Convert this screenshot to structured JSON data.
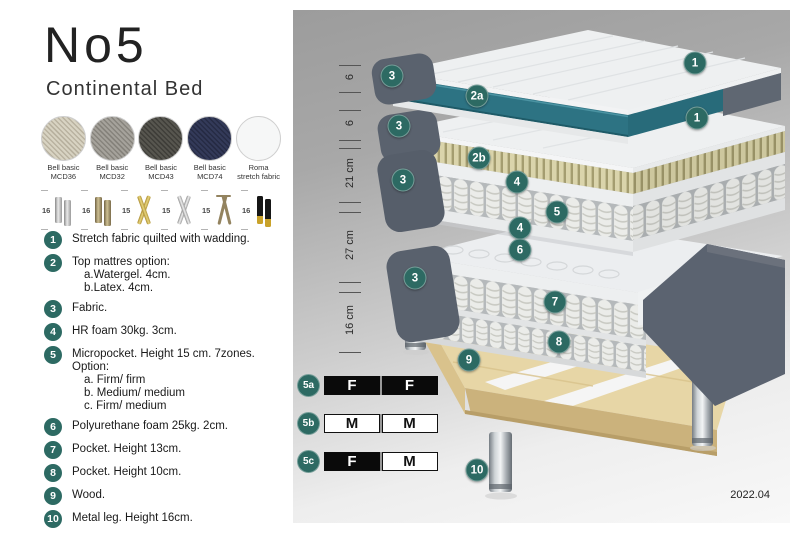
{
  "header": {
    "title": "No5",
    "subtitle": "Continental Bed"
  },
  "fabrics": [
    {
      "line1": "Bell basic",
      "line2": "MCD36",
      "color": "#d8d3c2",
      "weave": "#b9b2a0"
    },
    {
      "line1": "Bell basic",
      "line2": "MCD32",
      "color": "#a5a29b",
      "weave": "#86837c"
    },
    {
      "line1": "Bell basic",
      "line2": "MCD43",
      "color": "#57564f",
      "weave": "#3f3e39"
    },
    {
      "line1": "Bell basic",
      "line2": "MCD74",
      "color": "#333a59",
      "weave": "#262b44"
    },
    {
      "line1": "Roma",
      "line2": "stretch fabric",
      "color": "#f6f7f7",
      "weave": "#eceded"
    }
  ],
  "legs": [
    {
      "height": "16",
      "type": "cylinder-silver"
    },
    {
      "height": "16",
      "type": "cylinder-bronze"
    },
    {
      "height": "15",
      "type": "cross-gold"
    },
    {
      "height": "15",
      "type": "cross-silver"
    },
    {
      "height": "15",
      "type": "hairpin"
    },
    {
      "height": "16",
      "type": "block-black-gold"
    }
  ],
  "features": [
    {
      "num": "1",
      "text": "Stretch fabric quilted with wadding.",
      "subs": []
    },
    {
      "num": "2",
      "text": "Top mattres option:",
      "subs": [
        "a.Watergel. 4cm.",
        "b.Latex. 4cm."
      ]
    },
    {
      "num": "3",
      "text": "Fabric.",
      "subs": []
    },
    {
      "num": "4",
      "text": "HR foam 30kg. 3cm.",
      "subs": []
    },
    {
      "num": "5",
      "text": "Micropocket. Height 15 cm. 7zones. Option:",
      "subs": [
        "a. Firm/ firm",
        "b. Medium/ medium",
        "c. Firm/ medium"
      ]
    },
    {
      "num": "6",
      "text": "Polyurethane foam 25kg. 2cm.",
      "subs": []
    },
    {
      "num": "7",
      "text": "Pocket. Height 13cm.",
      "subs": []
    },
    {
      "num": "8",
      "text": "Pocket. Height 10cm.",
      "subs": []
    },
    {
      "num": "9",
      "text": "Wood.",
      "subs": []
    },
    {
      "num": "10",
      "text": "Metal leg. Height 16cm.",
      "subs": []
    }
  ],
  "diagram": {
    "dimensions": [
      {
        "label": "6",
        "y1": 55,
        "y2": 82
      },
      {
        "label": "6",
        "y1": 100,
        "y2": 130
      },
      {
        "label": "21 cm",
        "y1": 138,
        "y2": 192
      },
      {
        "label": "27 cm",
        "y1": 202,
        "y2": 272
      },
      {
        "label": "16 cm",
        "y1": 282,
        "y2": 342
      }
    ],
    "badges": [
      {
        "label": "1",
        "x": 402,
        "y": 53
      },
      {
        "label": "1",
        "x": 404,
        "y": 108
      },
      {
        "label": "3",
        "x": 99,
        "y": 66
      },
      {
        "label": "2a",
        "x": 184,
        "y": 86
      },
      {
        "label": "3",
        "x": 106,
        "y": 116
      },
      {
        "label": "2b",
        "x": 186,
        "y": 148
      },
      {
        "label": "4",
        "x": 224,
        "y": 172
      },
      {
        "label": "5",
        "x": 264,
        "y": 202
      },
      {
        "label": "3",
        "x": 110,
        "y": 170
      },
      {
        "label": "4",
        "x": 227,
        "y": 218
      },
      {
        "label": "6",
        "x": 227,
        "y": 240
      },
      {
        "label": "7",
        "x": 262,
        "y": 292
      },
      {
        "label": "3",
        "x": 122,
        "y": 268
      },
      {
        "label": "8",
        "x": 266,
        "y": 332
      },
      {
        "label": "9",
        "x": 176,
        "y": 350
      },
      {
        "label": "10",
        "x": 184,
        "y": 460
      }
    ],
    "firmness": [
      {
        "id": "5a",
        "cells": [
          {
            "letter": "F",
            "style": "dark"
          },
          {
            "letter": "F",
            "style": "dark"
          }
        ]
      },
      {
        "id": "5b",
        "cells": [
          {
            "letter": "M",
            "style": "light"
          },
          {
            "letter": "M",
            "style": "light"
          }
        ]
      },
      {
        "id": "5c",
        "cells": [
          {
            "letter": "F",
            "style": "dark"
          },
          {
            "letter": "M",
            "style": "light"
          }
        ]
      }
    ],
    "version": "2022.04"
  },
  "colors": {
    "badge_teal": "#2d6a63",
    "gel_teal": "#2d7383",
    "latex_cream": "#d9d3a9",
    "fabric_grey": "#5b6370",
    "wood": "#e7d6a6"
  }
}
